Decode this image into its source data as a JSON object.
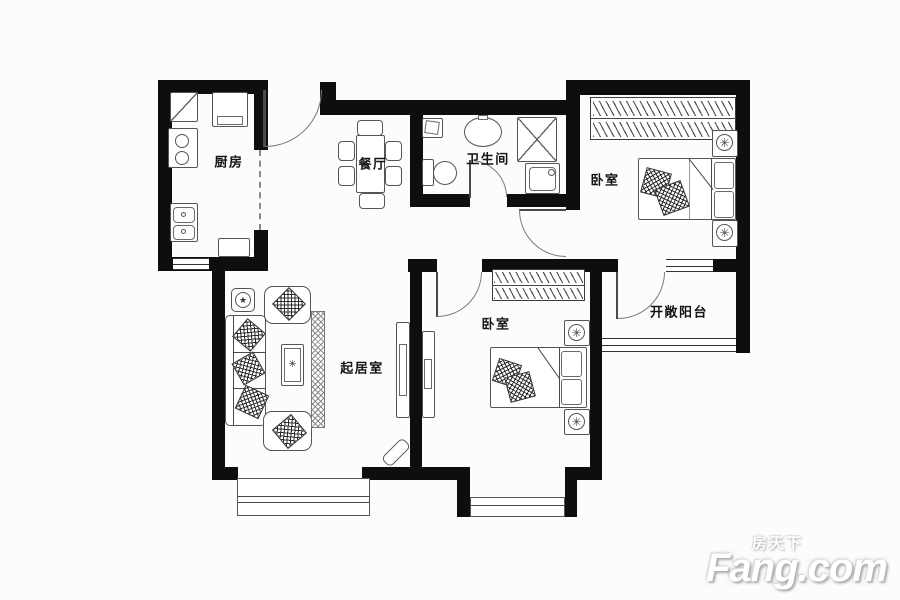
{
  "rooms": {
    "kitchen": {
      "label": "厨房"
    },
    "dining": {
      "label": "餐厅"
    },
    "bathroom": {
      "label": "卫生间"
    },
    "bedroom_master": {
      "label": "卧室"
    },
    "bedroom_second": {
      "label": "卧室"
    },
    "living": {
      "label": "起居室"
    },
    "balcony": {
      "label": "开敞阳台"
    }
  },
  "watermark": {
    "brand_cn": "房天下",
    "brand_en": "Fang.com"
  },
  "colors": {
    "wall": "#0e0e0e",
    "furniture_line": "#555555",
    "background": "#fcfcfc",
    "watermark": "#ffffff"
  },
  "icons": {
    "flower": "✳",
    "table_star": "✳",
    "plant": "★"
  }
}
